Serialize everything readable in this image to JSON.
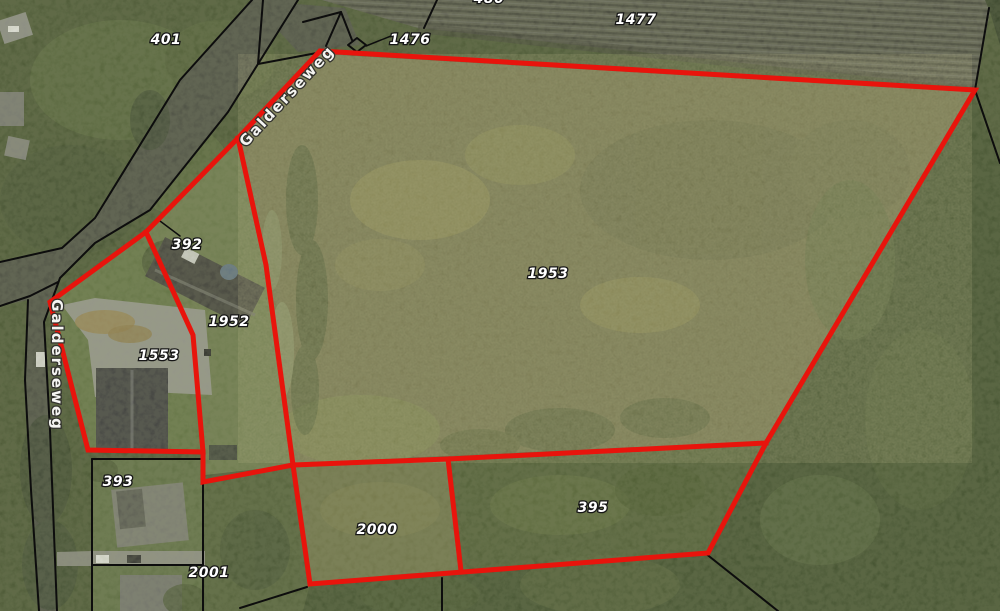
{
  "map": {
    "road_name": "Galderseweg",
    "parcel_labels": [
      {
        "id": "401",
        "text": "401",
        "x": 166,
        "y": 39
      },
      {
        "id": "1476",
        "text": "1476",
        "x": 410,
        "y": 39
      },
      {
        "id": "1477",
        "text": "1477",
        "x": 636,
        "y": 19
      },
      {
        "id": "392",
        "text": "392",
        "x": 187,
        "y": 244
      },
      {
        "id": "1952",
        "text": "1952",
        "x": 229,
        "y": 321
      },
      {
        "id": "1553",
        "text": "1553",
        "x": 159,
        "y": 355
      },
      {
        "id": "1953",
        "text": "1953",
        "x": 548,
        "y": 273
      },
      {
        "id": "393",
        "text": "393",
        "x": 118,
        "y": 481
      },
      {
        "id": "2001",
        "text": "2001",
        "x": 209,
        "y": 572
      },
      {
        "id": "2000",
        "text": "2000",
        "x": 377,
        "y": 529
      },
      {
        "id": "395",
        "text": "395",
        "x": 593,
        "y": 507
      }
    ],
    "partial_label": {
      "text": "480",
      "x": 489,
      "y": -2
    },
    "road_labels": [
      {
        "text": "Galderseweg",
        "x": 287,
        "y": 96,
        "rotation": -47
      },
      {
        "text": "Galderseweg",
        "x": 57,
        "y": 365,
        "rotation": 90
      }
    ],
    "selection": {
      "color": "#e8140c",
      "width": 5,
      "outline": [
        [
          320,
          51
        ],
        [
          975,
          90
        ],
        [
          766,
          443
        ],
        [
          708,
          553
        ],
        [
          463,
          572
        ],
        [
          310,
          584
        ],
        [
          293,
          465
        ],
        [
          203,
          482
        ],
        [
          203,
          452
        ],
        [
          88,
          450
        ],
        [
          50,
          302
        ],
        [
          146,
          232
        ],
        [
          238,
          138
        ],
        [
          320,
          51
        ]
      ],
      "inner_lines": [
        [
          [
            146,
            232
          ],
          [
            193,
            335
          ],
          [
            203,
            452
          ]
        ],
        [
          [
            238,
            138
          ],
          [
            266,
            265
          ],
          [
            293,
            465
          ]
        ],
        [
          [
            293,
            465
          ],
          [
            448,
            459
          ],
          [
            766,
            443
          ]
        ],
        [
          [
            448,
            459
          ],
          [
            461,
            571
          ]
        ]
      ]
    },
    "cadastral_lines": {
      "color": "#0d0d0d",
      "width": 2,
      "polylines": [
        [
          [
            263,
            0
          ],
          [
            258,
            64
          ],
          [
            322,
            52
          ]
        ],
        [
          [
            341,
            12
          ],
          [
            326,
            46
          ]
        ],
        [
          [
            341,
            12
          ],
          [
            352,
            40
          ]
        ],
        [
          [
            341,
            12
          ],
          [
            303,
            22
          ]
        ],
        [
          [
            437,
            0
          ],
          [
            424,
            28
          ]
        ],
        [
          [
            989,
            8
          ],
          [
            975,
            90
          ],
          [
            1000,
            163
          ]
        ],
        [
          [
            252,
            0
          ],
          [
            180,
            80
          ],
          [
            95,
            218
          ],
          [
            62,
            248
          ],
          [
            0,
            262
          ]
        ],
        [
          [
            298,
            0
          ],
          [
            228,
            112
          ],
          [
            150,
            210
          ],
          [
            95,
            243
          ],
          [
            60,
            278
          ],
          [
            44,
            322
          ],
          [
            50,
            430
          ],
          [
            57,
            611
          ]
        ],
        [
          [
            58,
            282
          ],
          [
            30,
            296
          ],
          [
            0,
            306
          ]
        ],
        [
          [
            28,
            300
          ],
          [
            25,
            380
          ],
          [
            31,
            490
          ],
          [
            39,
            611
          ]
        ],
        [
          [
            92,
            459
          ],
          [
            203,
            459
          ]
        ],
        [
          [
            92,
            459
          ],
          [
            92,
            611
          ]
        ],
        [
          [
            203,
            459
          ],
          [
            203,
            611
          ]
        ],
        [
          [
            92,
            565
          ],
          [
            203,
            565
          ]
        ],
        [
          [
            240,
            608
          ],
          [
            307,
            587
          ]
        ],
        [
          [
            442,
            578
          ],
          [
            442,
            611
          ]
        ],
        [
          [
            705,
            553
          ],
          [
            778,
            611
          ]
        ]
      ],
      "leader_lines": [
        [
          [
            366,
            46
          ],
          [
            396,
            34
          ]
        ],
        [
          [
            160,
            221
          ],
          [
            180,
            236
          ]
        ]
      ],
      "marker_diamond": [
        [
          357,
          38
        ],
        [
          366,
          45
        ],
        [
          357,
          52
        ],
        [
          348,
          45
        ]
      ]
    }
  }
}
